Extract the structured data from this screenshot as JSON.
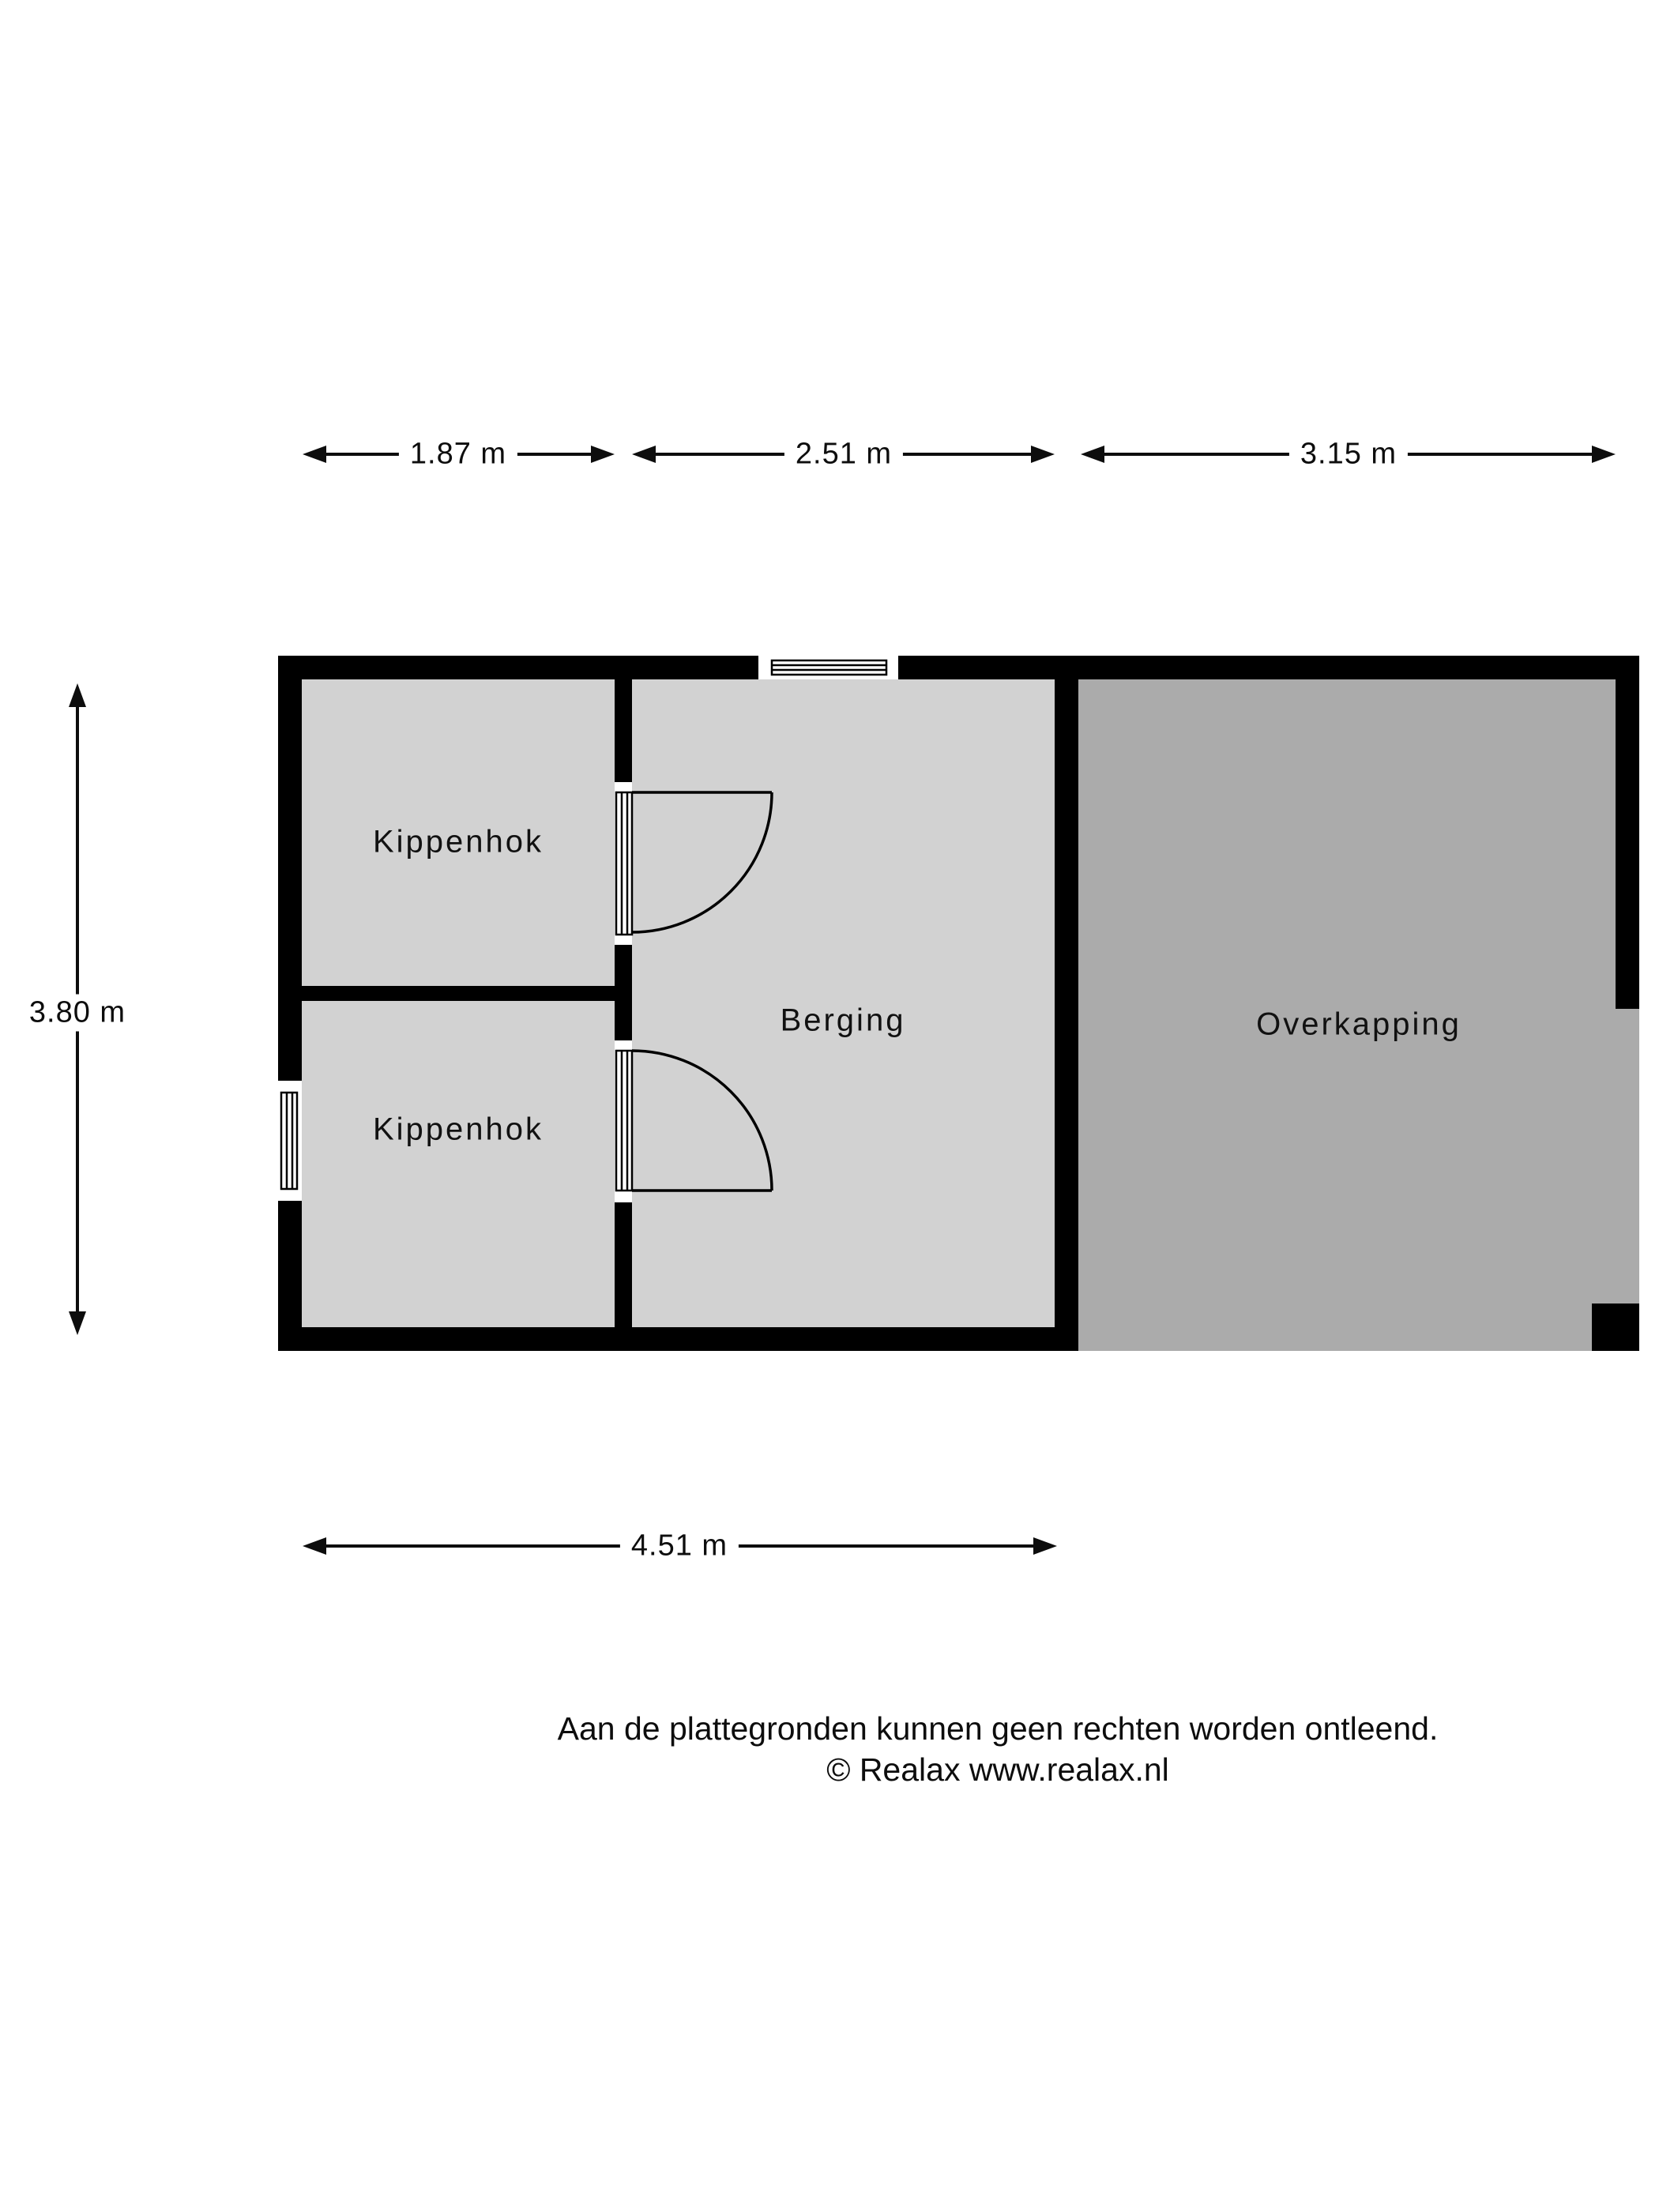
{
  "rooms": {
    "kippenhok_upper": "Kippenhok",
    "kippenhok_lower": "Kippenhok",
    "berging": "Berging",
    "overkapping": "Overkapping"
  },
  "dimensions": {
    "top_segments": [
      "1.87 m",
      "2.51 m",
      "3.15 m"
    ],
    "left": "3.80 m",
    "bottom": "4.51 m"
  },
  "footer": {
    "disclaimer": "Aan de plattegronden kunnen geen rechten worden ontleend.",
    "copyright": "© Realax www.realax.nl"
  },
  "colors": {
    "wall": "#000000",
    "room_fill": "#d2d2d2",
    "overkapping_fill": "#ababab",
    "background": "#ffffff"
  }
}
